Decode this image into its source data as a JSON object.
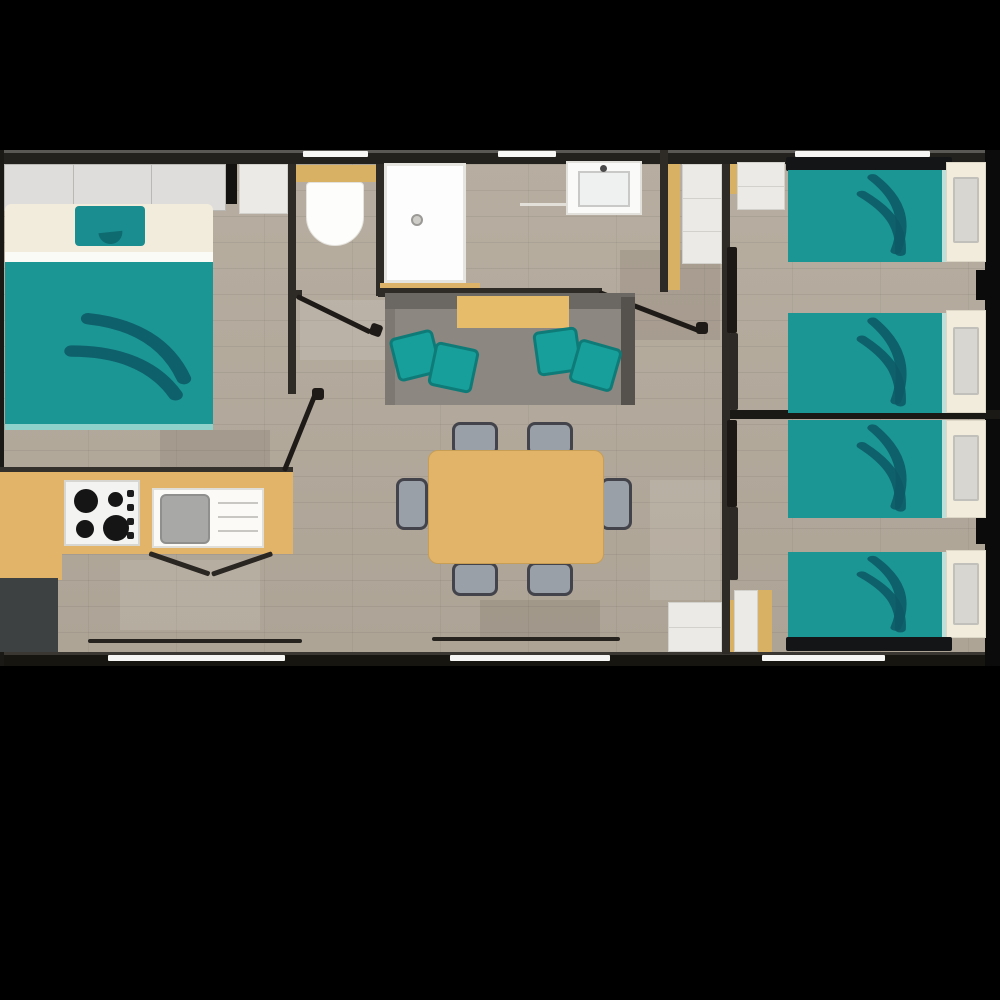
{
  "title": "mobile-home-floor-plan",
  "palette": {
    "background": "#000000",
    "wall": "#2e2b27",
    "wall_dark": "#1b1916",
    "floor_wood": "#b3a99b",
    "tan": "#e1b46a",
    "teal_bed": "#1b9695",
    "teal_cushion": "#17a09b",
    "teal_feather": "#0d5a66",
    "cream": "#f1ecdc",
    "white_fixture": "#fdfdfb",
    "cabinet_gray": "#dedddb",
    "sofa_gray": "#8d8781",
    "chair_gray": "#9aa0a8",
    "fridge_gray": "#3e4142",
    "pillow_gray": "#d8d6d1",
    "window_white": "#f6f6f4"
  },
  "rooms": [
    {
      "name": "master-bedroom",
      "furniture": [
        "wardrobe",
        "dresser",
        "double-bed"
      ]
    },
    {
      "name": "kitchen",
      "furniture": [
        "counter",
        "hob-4-burners",
        "sink",
        "fridge"
      ]
    },
    {
      "name": "wc",
      "furniture": [
        "toilet",
        "cistern"
      ]
    },
    {
      "name": "bathroom",
      "furniture": [
        "shower",
        "washbasin",
        "towel-bar"
      ]
    },
    {
      "name": "living-room",
      "furniture": [
        "sofa",
        "sofa-cushions-x4",
        "dining-table",
        "chairs-x6"
      ]
    },
    {
      "name": "twin-bedroom-top",
      "furniture": [
        "single-bed",
        "single-bed",
        "closet",
        "sliding-door"
      ]
    },
    {
      "name": "twin-bedroom-bottom",
      "furniture": [
        "single-bed",
        "single-bed",
        "wardrobe",
        "sliding-door"
      ]
    }
  ],
  "counts": {
    "double_beds": 1,
    "single_beds": 4,
    "dining_chairs": 6,
    "sofa_cushions": 4,
    "hob_burners": 4,
    "windows_top_wall": 3,
    "windows_bottom_wall": 3,
    "interior_doors": 5
  }
}
